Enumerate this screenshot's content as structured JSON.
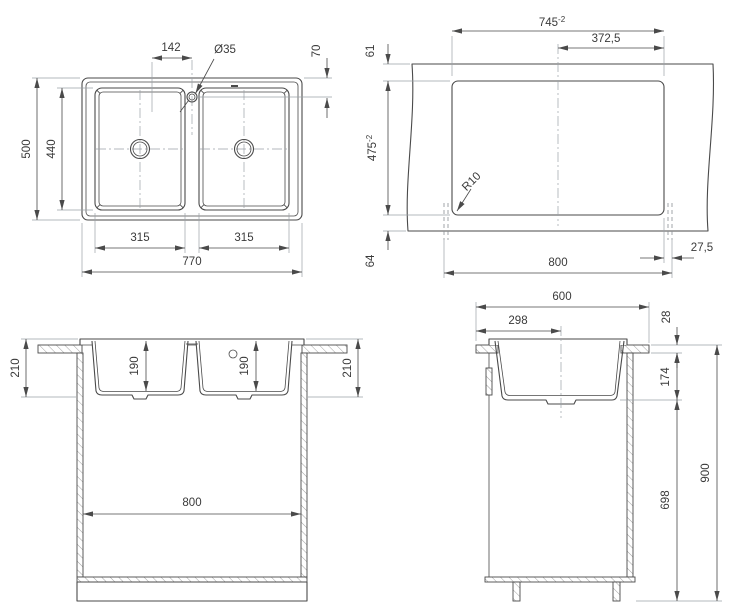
{
  "colors": {
    "line": "#4a4a4a",
    "extension_line": "#9aa0a6",
    "text": "#3a3a3a",
    "background": "#ffffff"
  },
  "top_view": {
    "bowl_pitch": "142",
    "faucet_hole": "Ø35",
    "hole_offset": "70",
    "depth": "500",
    "bowl_length": "440",
    "bowl_width_left": "315",
    "bowl_width_right": "315",
    "overall_width": "770"
  },
  "cutout_view": {
    "width": "745",
    "width_tol": "-2",
    "half_width": "372,5",
    "front_edge": "61",
    "height": "475",
    "height_tol": "-2",
    "corner_radius": "R10",
    "cabinet_width": "800",
    "side_gap": "27,5",
    "back_edge": "64"
  },
  "front_view": {
    "rim_depth_left": "210",
    "bowl_depth_left": "190",
    "bowl_depth_right": "190",
    "rim_depth_right": "210",
    "cabinet_inner_width": "800"
  },
  "side_view": {
    "counter_depth": "600",
    "center_offset": "298",
    "counter_thickness": "28",
    "bowl_under_depth": "174",
    "floor_clearance": "698",
    "worktop_height": "900"
  }
}
